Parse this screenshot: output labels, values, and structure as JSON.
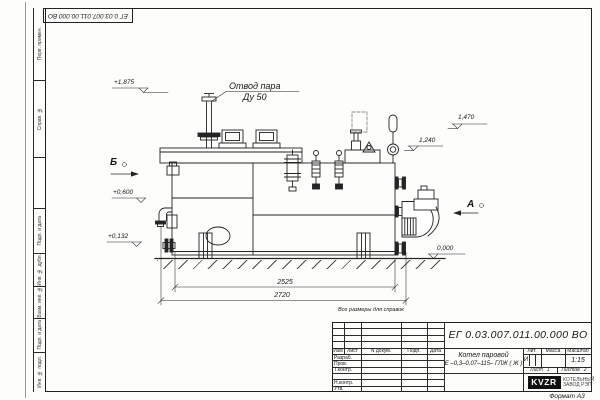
{
  "sheet": {
    "designation_top": "ЕГ 0.03.007.011.00.000  ВО",
    "format_note": "Формат А3",
    "margin_labels": {
      "perv_primen": "Перв. примен.",
      "sprav_no": "Справ. №",
      "podp_data_1": "Подп. и дата",
      "inv_dubl": "Инв. № дубл.",
      "vzam_inv": "Взам. инв. №",
      "podp_data_2": "Подп. и дата",
      "inv_podl": "Инв. № подл."
    }
  },
  "drawing": {
    "note": "Все размеры для справок",
    "callout": {
      "line1": "Отвод пара",
      "line2": "Ду 50"
    },
    "elevations": {
      "e1875": "+1,875",
      "e0600": "+0,600",
      "e0132": "+0,132",
      "e1470": "1,470",
      "e1240": "1,240",
      "e0000": "0,000"
    },
    "views": {
      "b": "Б",
      "a": "А"
    },
    "dims": {
      "d2525": "2525",
      "d2720": "2720"
    }
  },
  "title_block": {
    "designation": "ЕГ 0.03.007.011.00.000  ВО",
    "product_line1": "Котел паровой",
    "product_line2": "Е –0,3–0,07–115– ГЛЖ ( Ж )",
    "cols": {
      "izm": "Изм",
      "list": "Лист",
      "ndokum": "N докум.",
      "podp": "Подп.",
      "data": "Дата"
    },
    "roles": {
      "razrab": "Разраб.",
      "prov": "Пров.",
      "tkontr": "Т.контр.",
      "nkontr": "Н.контр.",
      "utv": "Утв."
    },
    "lit": {
      "header": "Лит.",
      "value": "И"
    },
    "massa": {
      "header": "Масса"
    },
    "masshtab": {
      "header": "Масштаб",
      "value": "1:15"
    },
    "sheet": {
      "label": "Лист",
      "value": "1"
    },
    "sheets": {
      "label": "Листов",
      "value": "2"
    },
    "company": {
      "logo": "KVZR",
      "name_line1": "КОТЕЛЬНЫЙ",
      "name_line2": "ЗАВОД РЭП"
    }
  }
}
